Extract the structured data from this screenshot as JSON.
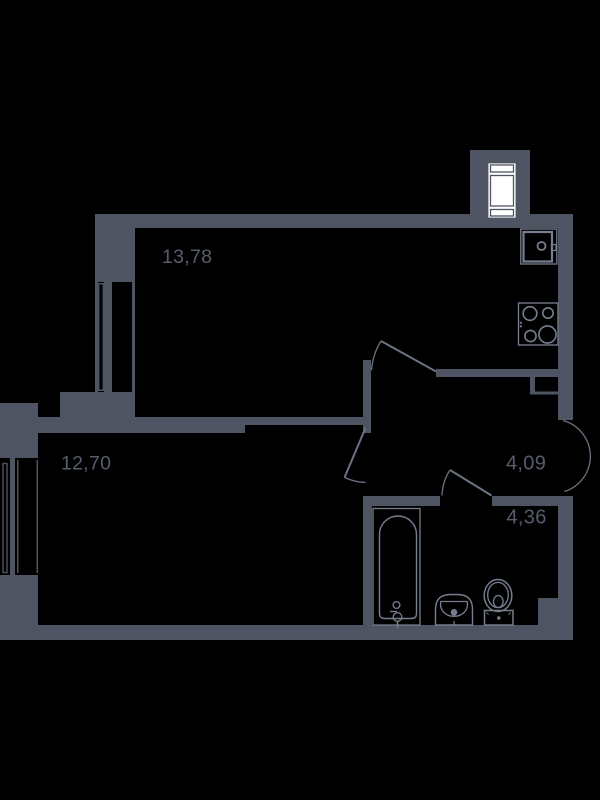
{
  "title": "Apartment floor plan",
  "colors": {
    "bg": "#000000",
    "wall": "#4e5462",
    "stroke": "#777e8f",
    "leaf": "#6b7284",
    "label": "#575d6b",
    "white": "#ffffff"
  },
  "rooms": [
    {
      "name": "living-kitchen",
      "area": "13,78"
    },
    {
      "name": "bedroom",
      "area": "12,70"
    },
    {
      "name": "hallway",
      "area": "4,09"
    },
    {
      "name": "bathroom",
      "area": "4,36"
    }
  ],
  "fixtures": [
    "shaft-window",
    "kitchen-sink",
    "stove-4-burners",
    "duct-shaft",
    "window-left-upper",
    "window-left-lower",
    "bathtub",
    "washbasin",
    "toilet",
    "door-kitchen",
    "door-bedroom",
    "door-bathroom",
    "door-entry"
  ]
}
